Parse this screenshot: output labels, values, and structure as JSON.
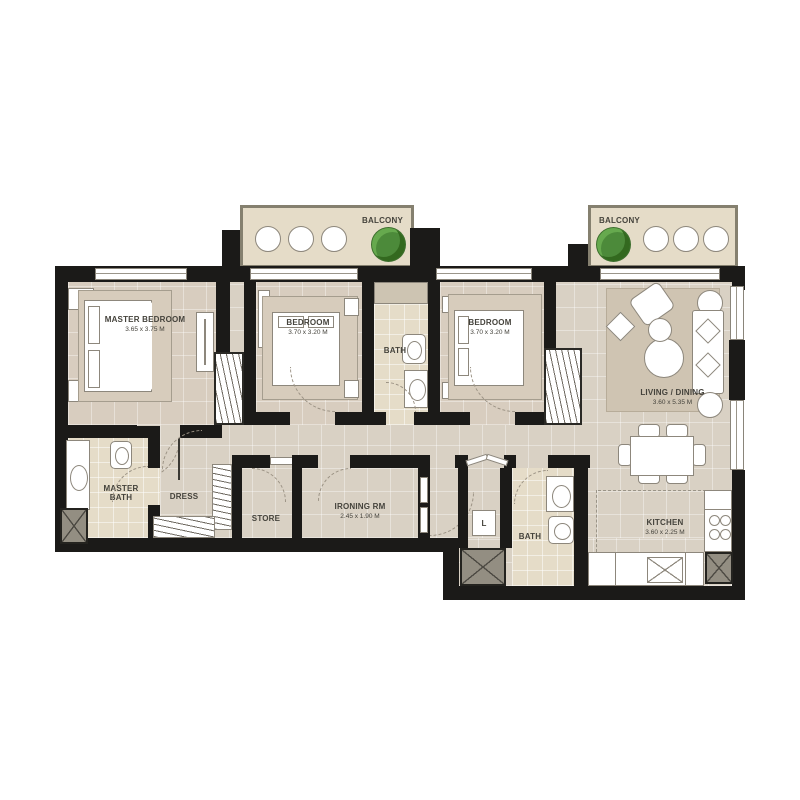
{
  "rooms": {
    "balcony_left": {
      "name": "BALCONY"
    },
    "balcony_right": {
      "name": "BALCONY"
    },
    "master_bedroom": {
      "name": "MASTER BEDROOM",
      "dims": "3.65 x 3.75 M"
    },
    "bedroom_mid": {
      "name": "BEDROOM",
      "dims": "3.70 x 3.20 M"
    },
    "bath_top": {
      "name": "BATH"
    },
    "bedroom_right": {
      "name": "BEDROOM",
      "dims": "3.70 x 3.20 M"
    },
    "living_dining": {
      "name": "LIVING / DINING",
      "dims": "3.60 x 5.35 M"
    },
    "master_bath": {
      "name": "MASTER BATH"
    },
    "dress": {
      "name": "DRESS"
    },
    "store": {
      "name": "STORE"
    },
    "ironing_room": {
      "name": "IRONING RM",
      "dims": "2.45 x 1.90 M"
    },
    "laundry_closet": {
      "name": "L"
    },
    "bath_bottom": {
      "name": "BATH"
    },
    "kitchen": {
      "name": "KITCHEN",
      "dims": "3.60 x 2.25 M"
    }
  },
  "colors": {
    "wall": "#1b1a18",
    "floor": "#d9d1c4",
    "floor_warm": "#d8cdbf",
    "tile": "#e5dcc8",
    "rug": "#cfc4b2",
    "bed_platform": "#d7ccbc",
    "furniture_outline": "#8d877c",
    "shaft": "#938e82",
    "balcony_wall": "#85806f",
    "plant": "#4c8a3a",
    "label_text": "#45433c",
    "white": "#ffffff"
  }
}
